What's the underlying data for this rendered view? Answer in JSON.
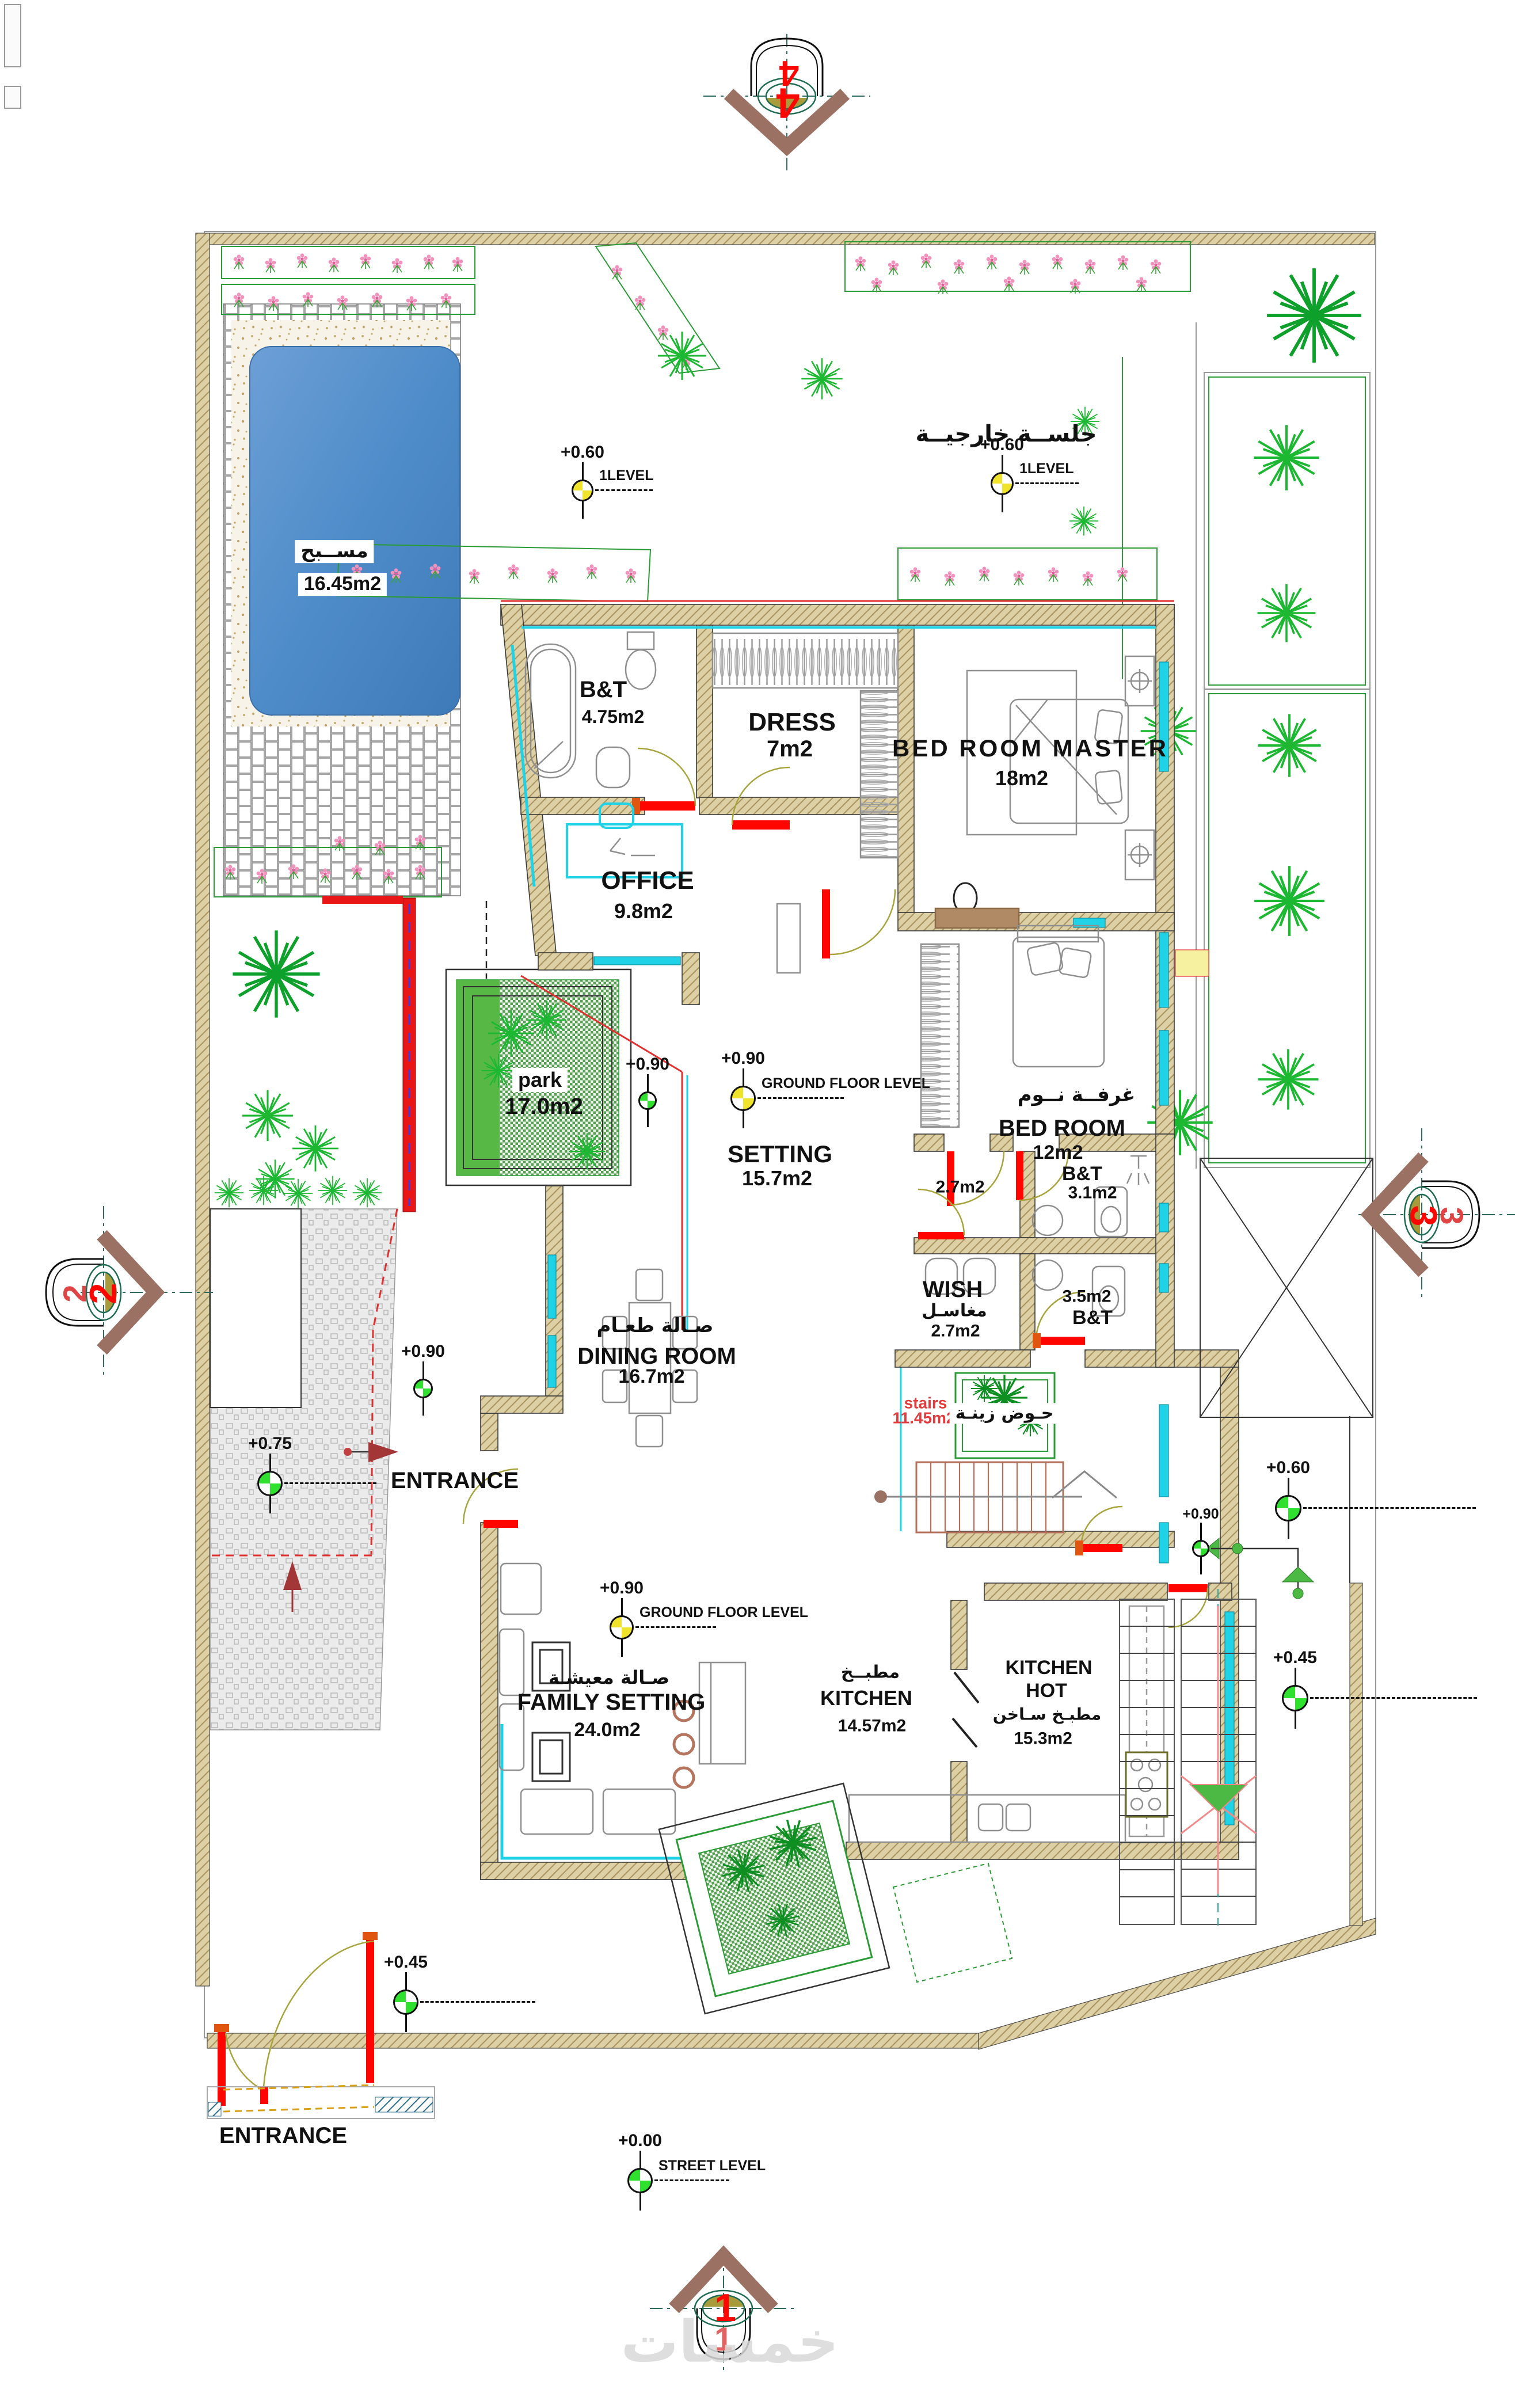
{
  "plan": {
    "watermark": "خمسات",
    "section_markers": {
      "top": "4",
      "bottom": "1",
      "left": "2",
      "right": "3"
    },
    "levels": {
      "pool_side": {
        "value": "+0.60",
        "label": "1LEVEL"
      },
      "seating": {
        "value": "+0.60",
        "label": "1LEVEL"
      },
      "setting": {
        "value": "+0.90",
        "label": "GROUND FLOOR LEVEL"
      },
      "park": {
        "value": "+0.90"
      },
      "driveway": {
        "value": "+0.75"
      },
      "entrance": {
        "value": "+0.90"
      },
      "family": {
        "value": "+0.90",
        "label": "GROUND FLOOR LEVEL"
      },
      "east_upper": {
        "value": "+0.60"
      },
      "east_mid": {
        "value": "+0.90"
      },
      "east_lower": {
        "value": "+0.45"
      },
      "gate": {
        "value": "+0.45"
      },
      "street": {
        "value": "+0.00",
        "label": "STREET LEVEL"
      }
    },
    "rooms": {
      "pool": {
        "name_ar": "مســبح",
        "area": "16.45m2"
      },
      "seating": {
        "name_ar": "جلســة خارجيــة"
      },
      "bt1": {
        "name": "B&T",
        "area": "4.75m2"
      },
      "dress": {
        "name": "DRESS",
        "area": "7m2"
      },
      "master": {
        "name": "BED ROOM MASTER",
        "area": "18m2"
      },
      "office": {
        "name": "OFFICE",
        "area": "9.8m2"
      },
      "park": {
        "name": "park",
        "area": "17.0m2"
      },
      "setting": {
        "name": "SETTING",
        "area": "15.7m2"
      },
      "bedroom": {
        "name": "BED ROOM",
        "name_ar": "غرفــة نــوم",
        "area": "12m2"
      },
      "room27": {
        "area": "2.7m2"
      },
      "bt2": {
        "name": "B&T",
        "area": "3.1m2"
      },
      "wish": {
        "name": "WISH",
        "name_ar": "مغاسـل",
        "area": "2.7m2"
      },
      "bt3": {
        "name": "B&T",
        "area": "3.5m2"
      },
      "dining": {
        "name": "DINING ROOM",
        "name_ar": "صـالة طعـام",
        "area": "16.7m2"
      },
      "stairs": {
        "name": "stairs",
        "area": "11.45m2"
      },
      "planter": {
        "name_ar": "حـوض زينـة"
      },
      "entrance_main": {
        "name": "ENTRANCE"
      },
      "family": {
        "name": "FAMILY SETTING",
        "name_ar": "صـالة معيشـة",
        "area": "24.0m2"
      },
      "kitchen": {
        "name": "KITCHEN",
        "name_ar": "مطبــخ",
        "area": "14.57m2"
      },
      "kitchen_hot": {
        "name": "KITCHEN",
        "name2": "HOT",
        "name_ar": "مطبـخ سـاخن",
        "area": "15.3m2"
      },
      "entrance_gate": {
        "name": "ENTRANCE"
      }
    },
    "colors": {
      "wall": "#d8cba1",
      "window": "#1fd2e6",
      "door": "#fe0500",
      "plant": "#1db832",
      "pool": "#4e8cc9",
      "stairs_text": "#e23c3c",
      "marker_green": "#2fe02f",
      "marker_yellow": "#f0e32b",
      "section_arrow": "#9b7164",
      "section_number": "#fe0500"
    }
  }
}
